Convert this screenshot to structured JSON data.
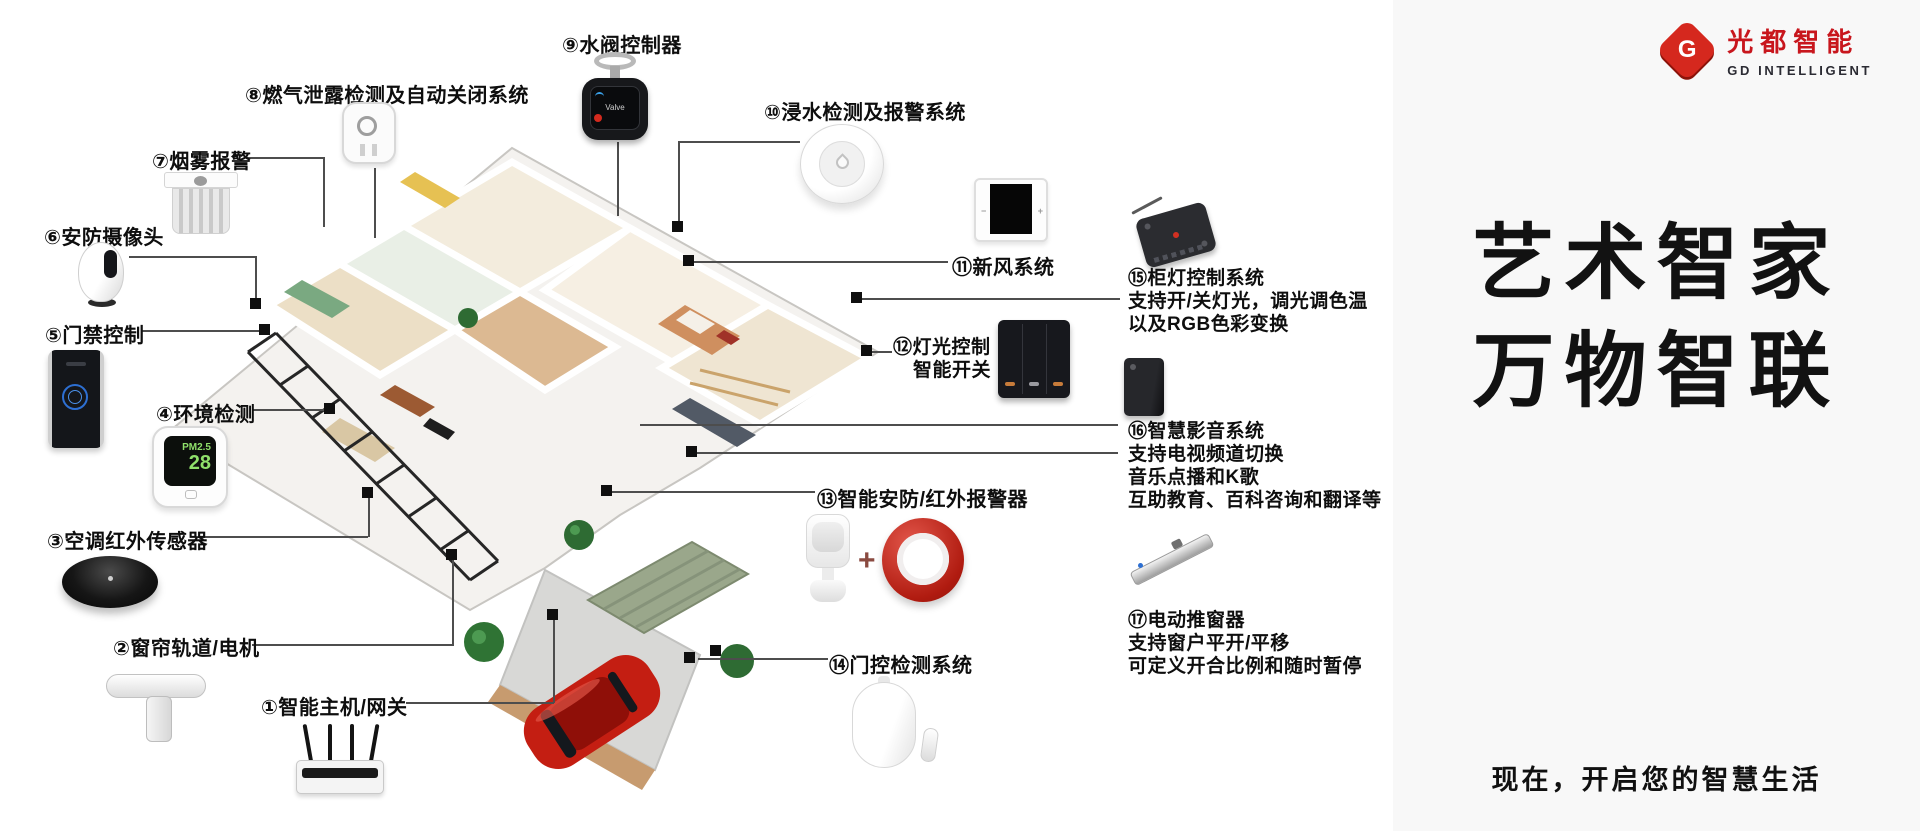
{
  "brand": {
    "logo_letter": "G",
    "name_cn": "光都智能",
    "name_en": "GD INTELLIGENT",
    "headline_line1": "艺术智家",
    "headline_line2": "万物智联",
    "tagline": "现在，开启您的智慧生活",
    "accent_red": "#c8161d"
  },
  "device_screens": {
    "env_metric": "PM2.5",
    "env_value": "28",
    "valve_text": "Valve",
    "phone_line1": "SMART",
    "phone_line2": "HOME"
  },
  "annotations": {
    "a1": {
      "label": "①智能主机/网关"
    },
    "a2": {
      "label": "②窗帘轨道/电机"
    },
    "a3": {
      "label": "③空调红外传感器"
    },
    "a4": {
      "label": "④环境检测"
    },
    "a5": {
      "label": "⑤门禁控制"
    },
    "a6": {
      "label": "⑥安防摄像头"
    },
    "a7": {
      "label": "⑦烟雾报警"
    },
    "a8": {
      "label": "⑧燃气泄露检测及自动关闭系统"
    },
    "a9": {
      "label": "⑨水阀控制器"
    },
    "a10": {
      "label": "⑩浸水检测及报警系统"
    },
    "a11": {
      "label": "⑪新风系统"
    },
    "a12": {
      "label": "⑫灯光控制",
      "label2": "智能开关"
    },
    "a13": {
      "label": "⑬智能安防/红外报警器",
      "plus": "+"
    },
    "a14": {
      "label": "⑭门控检测系统"
    },
    "a15": {
      "label": "⑮柜灯控制系统",
      "desc1": "支持开/关灯光，调光调色温",
      "desc2": "以及RGB色彩变换"
    },
    "a16": {
      "label": "⑯智慧影音系统",
      "desc1": "支持电视频道切换",
      "desc2": "音乐点播和K歌",
      "desc3": "互助教育、百科咨询和翻译等"
    },
    "a17": {
      "label": "⑰电动推窗器",
      "desc1": "支持窗户平开/平移",
      "desc2": "可定义开合比例和随时暂停"
    }
  }
}
